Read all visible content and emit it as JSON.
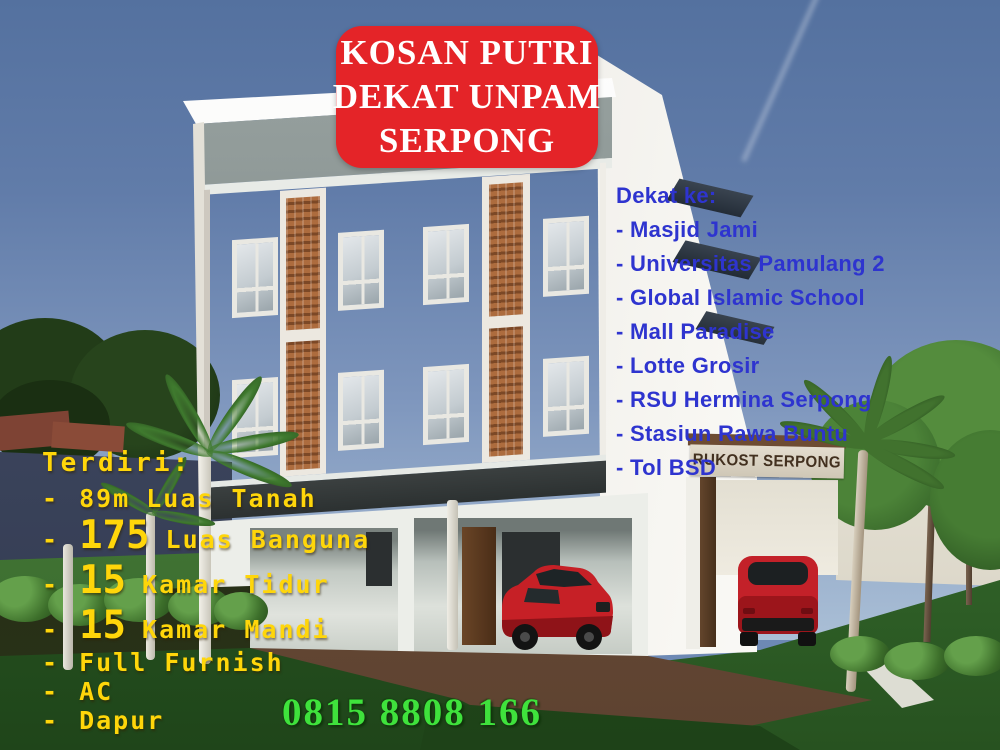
{
  "banner": {
    "line1": "KOSAN PUTRI",
    "line2": "DEKAT UNPAM",
    "line3": "SERPONG",
    "bg_color": "#e42428",
    "text_color": "#ffffff"
  },
  "nearby": {
    "heading": "Dekat ke:",
    "items": [
      "- Masjid Jami",
      "- Universitas Pamulang 2",
      "- Global Islamic School",
      "- Mall Paradise",
      "- Lotte Grosir",
      "- RSU Hermina Serpong",
      "- Stasiun Rawa Buntu",
      "- Tol BSD"
    ],
    "text_color": "#2e34cf"
  },
  "features": {
    "heading": "Terdiri:",
    "items": [
      {
        "dash": "-",
        "num": "89m",
        "text": "Luas Tanah"
      },
      {
        "dash": "-",
        "num": "175",
        "text": "Luas Banguna"
      },
      {
        "dash": "-",
        "num": "15",
        "text": "Kamar Tidur"
      },
      {
        "dash": "-",
        "num": "15",
        "text": "Kamar Mandi"
      },
      {
        "dash": "-",
        "num": "",
        "text": "Full Furnish"
      },
      {
        "dash": "-",
        "num": "",
        "text": "AC"
      },
      {
        "dash": "-",
        "num": "",
        "text": "Dapur"
      }
    ],
    "text_color": "#ffd60a"
  },
  "contact": {
    "phone": "0815 8808 166",
    "color": "#3fe23c"
  },
  "building": {
    "sign_text": "RUKOST SERPONG"
  },
  "scene_colors": {
    "sky_top": "#54719f",
    "sky_bottom": "#aabfd6",
    "facade_brown": "#4e2f1b",
    "brick_accent": "#ad6c3e",
    "wall_white": "#f3f2ee",
    "grass": "#2f6529",
    "pavement": "#6e4c36",
    "car_red": "#c62026"
  }
}
